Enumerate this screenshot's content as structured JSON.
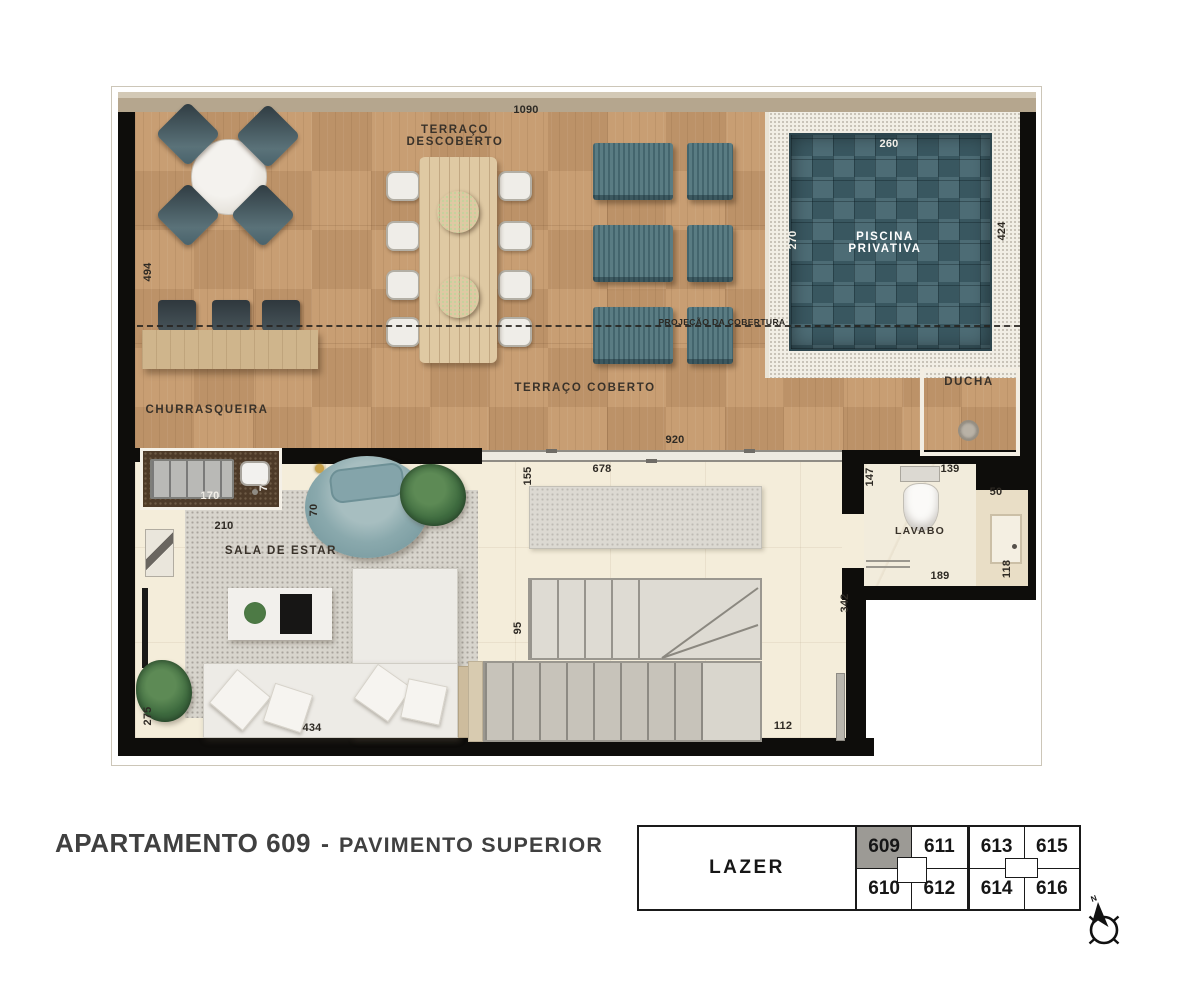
{
  "title": {
    "main": "APARTAMENTO 609",
    "dash": "-",
    "sub": "PAVIMENTO SUPERIOR"
  },
  "plan": {
    "rooms": {
      "terraco_descoberto_1": "TERRAÇO",
      "terraco_descoberto_2": "DESCOBERTO",
      "terraco_coberto": "TERRAÇO COBERTO",
      "churrasqueira": "CHURRASQUEIRA",
      "piscina_1": "PISCINA",
      "piscina_2": "PRIVATIVA",
      "ducha": "DUCHA",
      "sala": "SALA DE ESTAR",
      "lavabo": "LAVABO",
      "projecao": "PROJEÇÃO DA COBERTURA"
    },
    "dims": {
      "terrace_width": "1090",
      "terrace_height": "494",
      "pool_width": "260",
      "pool_depth": "270",
      "pool_deck_height": "424",
      "grill_width": "170",
      "grill_sink_depth": "70",
      "door_width": "920",
      "sideboard_width": "678",
      "sideboard_depth": "155",
      "living_width": "210",
      "armchair_depth": "70",
      "sofa_width": "434",
      "living_height": "275",
      "stair_width": "95",
      "hall_height": "342",
      "hall_width": "112",
      "lavabo_width": "139",
      "lavabo_height": "147",
      "basin_width": "50",
      "lavabo_bottom": "189",
      "basin_height": "118"
    }
  },
  "keyplan": {
    "zone_label": "LAZER",
    "top_row": [
      "609",
      "611",
      "613",
      "615"
    ],
    "bottom_row": [
      "610",
      "612",
      "614",
      "616"
    ],
    "highlight": "609"
  },
  "compass": {
    "north": "N"
  },
  "colors": {
    "wood": "#c69a6e",
    "pool": "#40616b",
    "teal": "#547179",
    "floor": "#f4edda",
    "highlight_cell": "#9c9a95"
  }
}
